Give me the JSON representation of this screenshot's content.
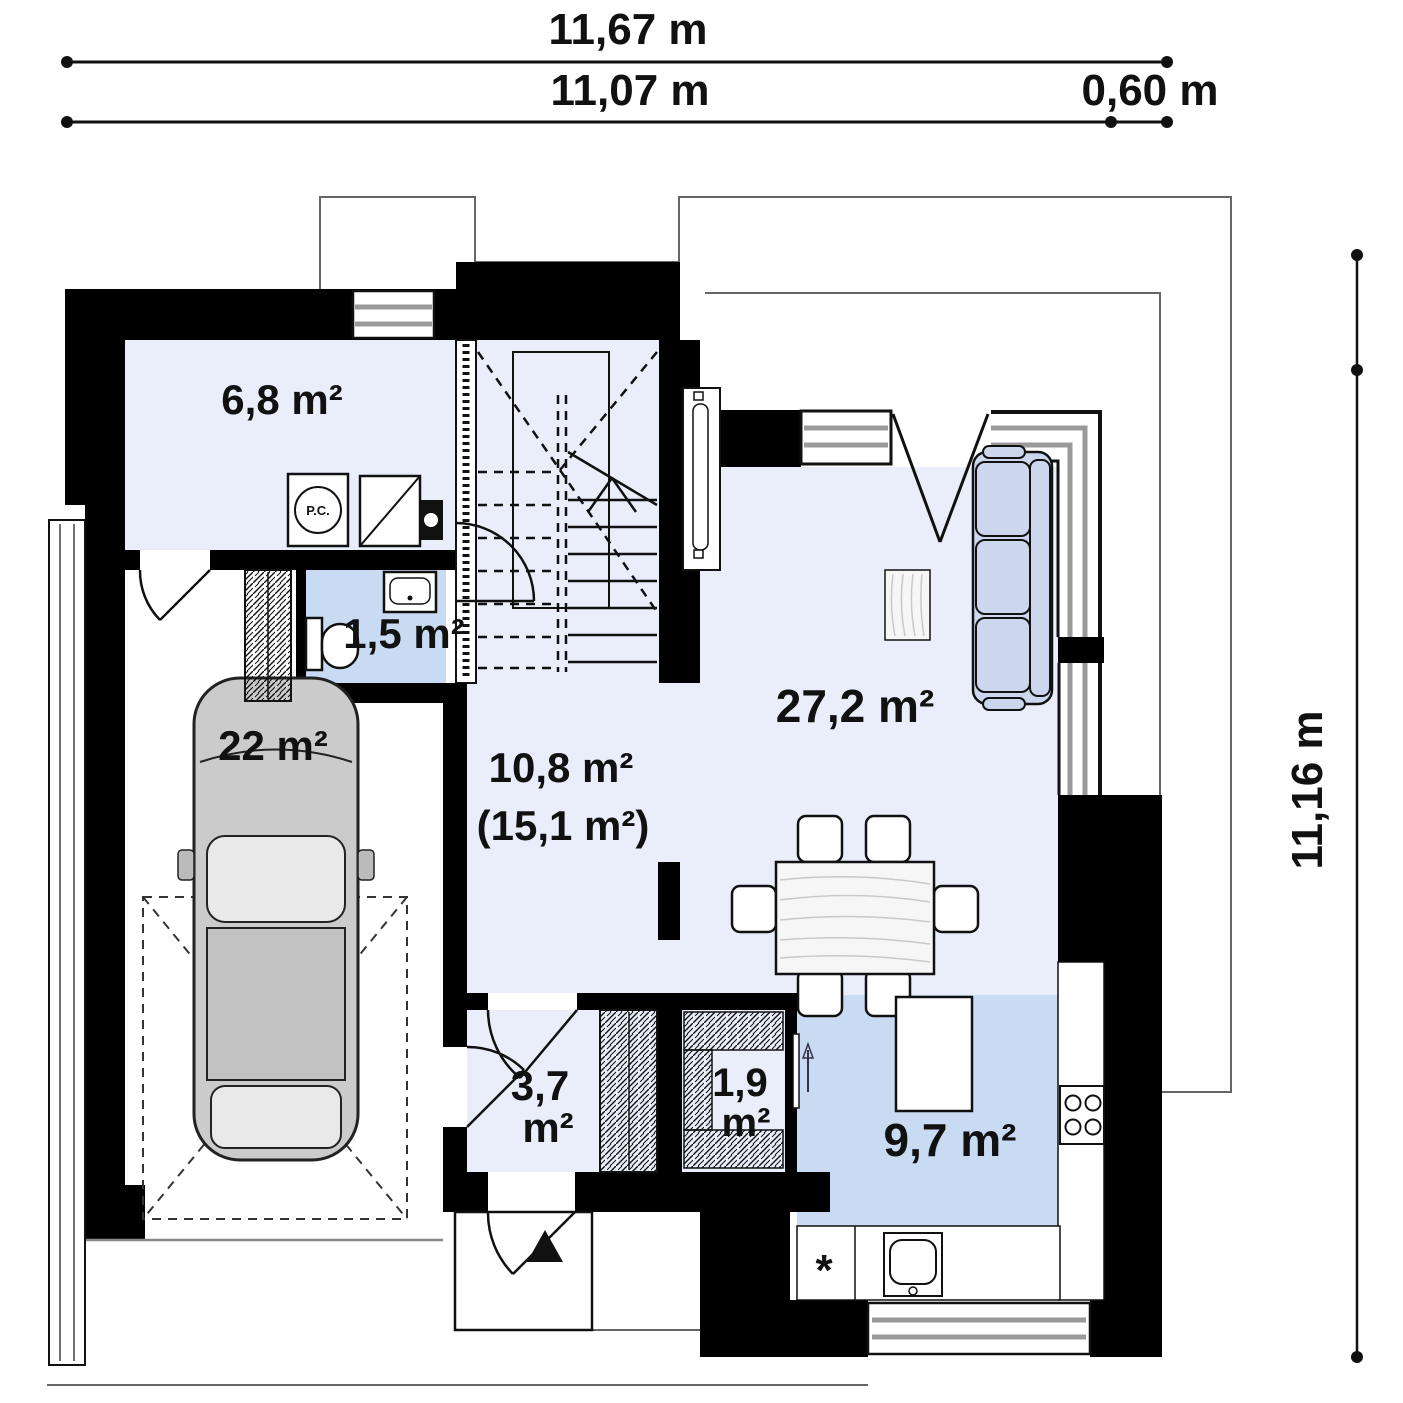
{
  "dimensions": {
    "top_total": "11,67 m",
    "top_main": "11,07 m",
    "top_offset": "0,60 m",
    "right_total": "11,16 m"
  },
  "rooms": {
    "utility": {
      "area": "6,8 m²"
    },
    "bathroom": {
      "area": "1,5 m²"
    },
    "garage": {
      "area": "22 m²"
    },
    "hall": {
      "area_lines": [
        "10,8 m²",
        "(15,1 m²)"
      ]
    },
    "living": {
      "area": "27,2 m²"
    },
    "entry": {
      "area_lines": [
        "3,7",
        "m²"
      ]
    },
    "closet": {
      "area_lines": [
        "1,9",
        "m²"
      ]
    },
    "kitchen": {
      "area": "9,7 m²"
    }
  },
  "symbols": {
    "washer_label": "P.C.",
    "counter_marker": "*"
  },
  "colors": {
    "wall": "#000000",
    "floor-light": "#e9eefa",
    "floor-blue": "#c9dbf2",
    "sofa": "#ccd7ee",
    "car-body": "#cbcbcb",
    "glass-line": "#9a9a9a",
    "outline-gray": "#666666"
  }
}
